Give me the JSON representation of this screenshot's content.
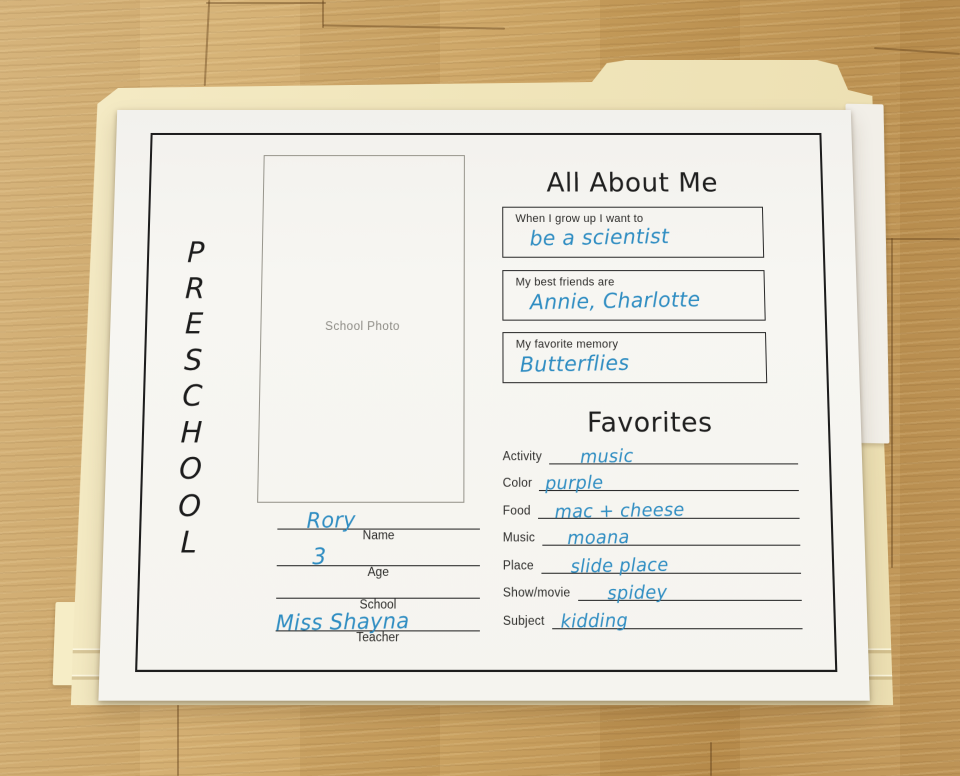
{
  "worksheet": {
    "side_label": "PRESCHOOL",
    "side_letters": [
      "P",
      "R",
      "E",
      "S",
      "C",
      "H",
      "O",
      "O",
      "L"
    ],
    "photo_box_label": "School Photo",
    "identity_fields": [
      {
        "label": "Name",
        "value": "Rory"
      },
      {
        "label": "Age",
        "value": "3"
      },
      {
        "label": "School",
        "value": ""
      },
      {
        "label": "Teacher",
        "value": "Miss Shayna"
      }
    ],
    "about": {
      "title": "All About Me",
      "prompts": [
        {
          "prompt": "When I grow up I want to",
          "answer": "be a scientist"
        },
        {
          "prompt": "My best friends are",
          "answer": "Annie, Charlotte"
        },
        {
          "prompt": "My favorite memory",
          "answer": "Butterflies"
        }
      ]
    },
    "favorites": {
      "title": "Favorites",
      "rows": [
        {
          "label": "Activity",
          "answer": "music"
        },
        {
          "label": "Color",
          "answer": "purple"
        },
        {
          "label": "Food",
          "answer": "mac + cheese"
        },
        {
          "label": "Music",
          "answer": "moana"
        },
        {
          "label": "Place",
          "answer": "slide place"
        },
        {
          "label": "Show/movie",
          "answer": "spidey"
        },
        {
          "label": "Subject",
          "answer": "kidding"
        }
      ]
    }
  },
  "colors": {
    "ink_blue": "#2f8dc2",
    "paper": "#f5f4ef",
    "folder_manila": "#f0e5ba",
    "wood": "#c69c5a",
    "frame": "#1d1d1d"
  }
}
